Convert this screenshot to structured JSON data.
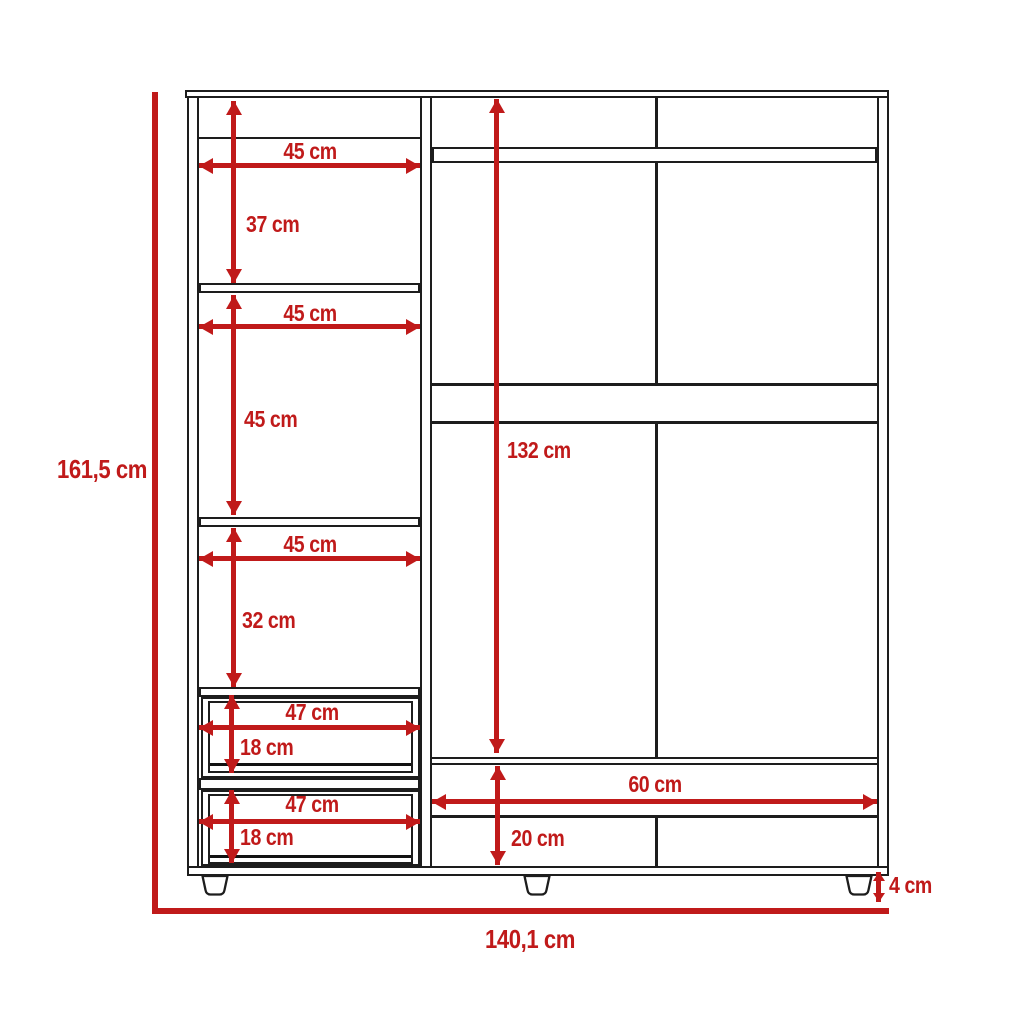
{
  "diagram": {
    "type": "furniture technical drawing",
    "subject": "wardrobe front elevation with dimensions",
    "units": "cm"
  },
  "colors": {
    "dimension_red": "#c01a1a",
    "outline_black": "#1d1d1d",
    "background": "#ffffff"
  },
  "overall_dimensions": {
    "height": "161,5 cm",
    "width": "140,1 cm",
    "foot_height": "4 cm"
  },
  "left_column": {
    "top_shelf": {
      "width": "45 cm",
      "height": "37 cm"
    },
    "middle_shelf": {
      "width": "45 cm",
      "height": "45 cm"
    },
    "lower_shelf": {
      "width": "45 cm",
      "height": "32 cm"
    },
    "drawer_1": {
      "width": "47 cm",
      "height": "18 cm"
    },
    "drawer_2": {
      "width": "47 cm",
      "height": "18 cm"
    }
  },
  "right_section": {
    "interior_height": "132 cm",
    "bottom_compartment_width": "60 cm",
    "bottom_compartment_height": "20 cm"
  }
}
